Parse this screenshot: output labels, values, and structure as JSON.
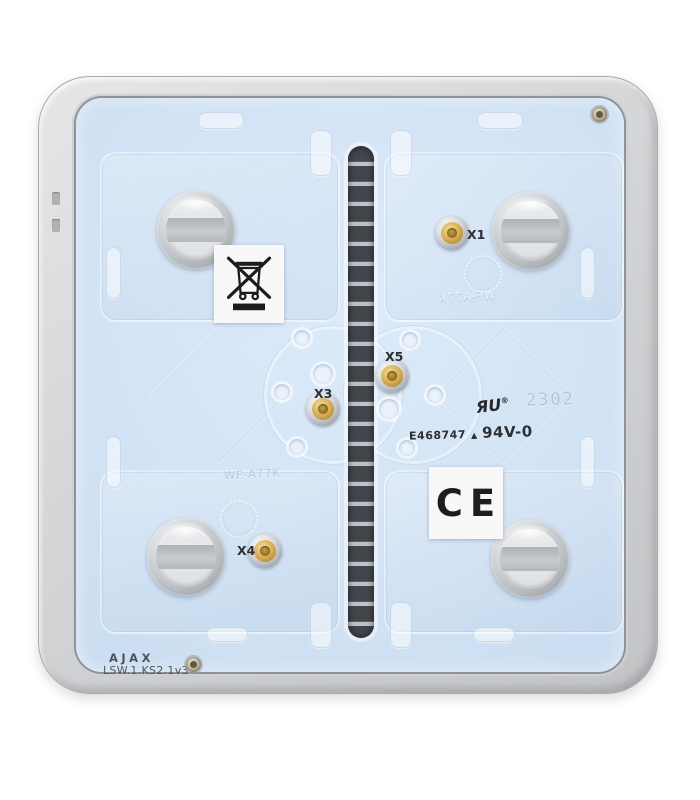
{
  "colors": {
    "background": "#ffffff",
    "frame_gray": "#d2d3d5",
    "panel_blue": "#cfe0f3",
    "slot_dark": "#45474d",
    "metal_disc": "#c8cbcf",
    "gold_contact": "#d3a94e",
    "sticker_white": "#f8f8f8",
    "print_black": "#2d2f36",
    "embossed_code": "#b9c5d7"
  },
  "icons": {
    "weee": "weee-crossed-out-wheelie-bin-icon",
    "ul": "ul-recognized-component-icon",
    "bursts": "molded-starburst-icon"
  },
  "brand": {
    "logo_text": "AJAX",
    "model_text": "LSW.1.KS2.1v3"
  },
  "contacts": [
    {
      "label": "X1"
    },
    {
      "label": "X3"
    },
    {
      "label": "X4"
    },
    {
      "label": "X5"
    }
  ],
  "markings": {
    "ul_file_number": "E468747",
    "triangle": "▲",
    "flammability_rating": "94V-0",
    "ul_mark": "ЯU",
    "registered": "®",
    "date_code": "2302",
    "molded_text": "WF-A77K"
  },
  "labels": {
    "ce_text": "CE"
  }
}
